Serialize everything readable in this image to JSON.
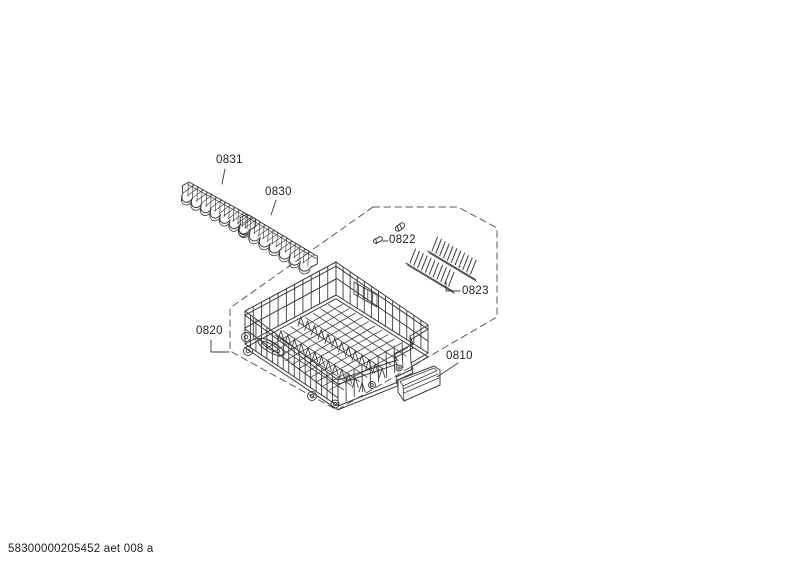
{
  "diagram": {
    "parts": {
      "p0831": {
        "label": "0831"
      },
      "p0830": {
        "label": "0830"
      },
      "p0822": {
        "label": "0822"
      },
      "p0823": {
        "label": "0823"
      },
      "p0820": {
        "label": "0820"
      },
      "p0810": {
        "label": "0810"
      }
    },
    "footer_code": "58300000205452 aet 008 a",
    "line_color": "#3c3c3c",
    "dash_color": "#5a5a5a",
    "background_color": "#ffffff"
  }
}
